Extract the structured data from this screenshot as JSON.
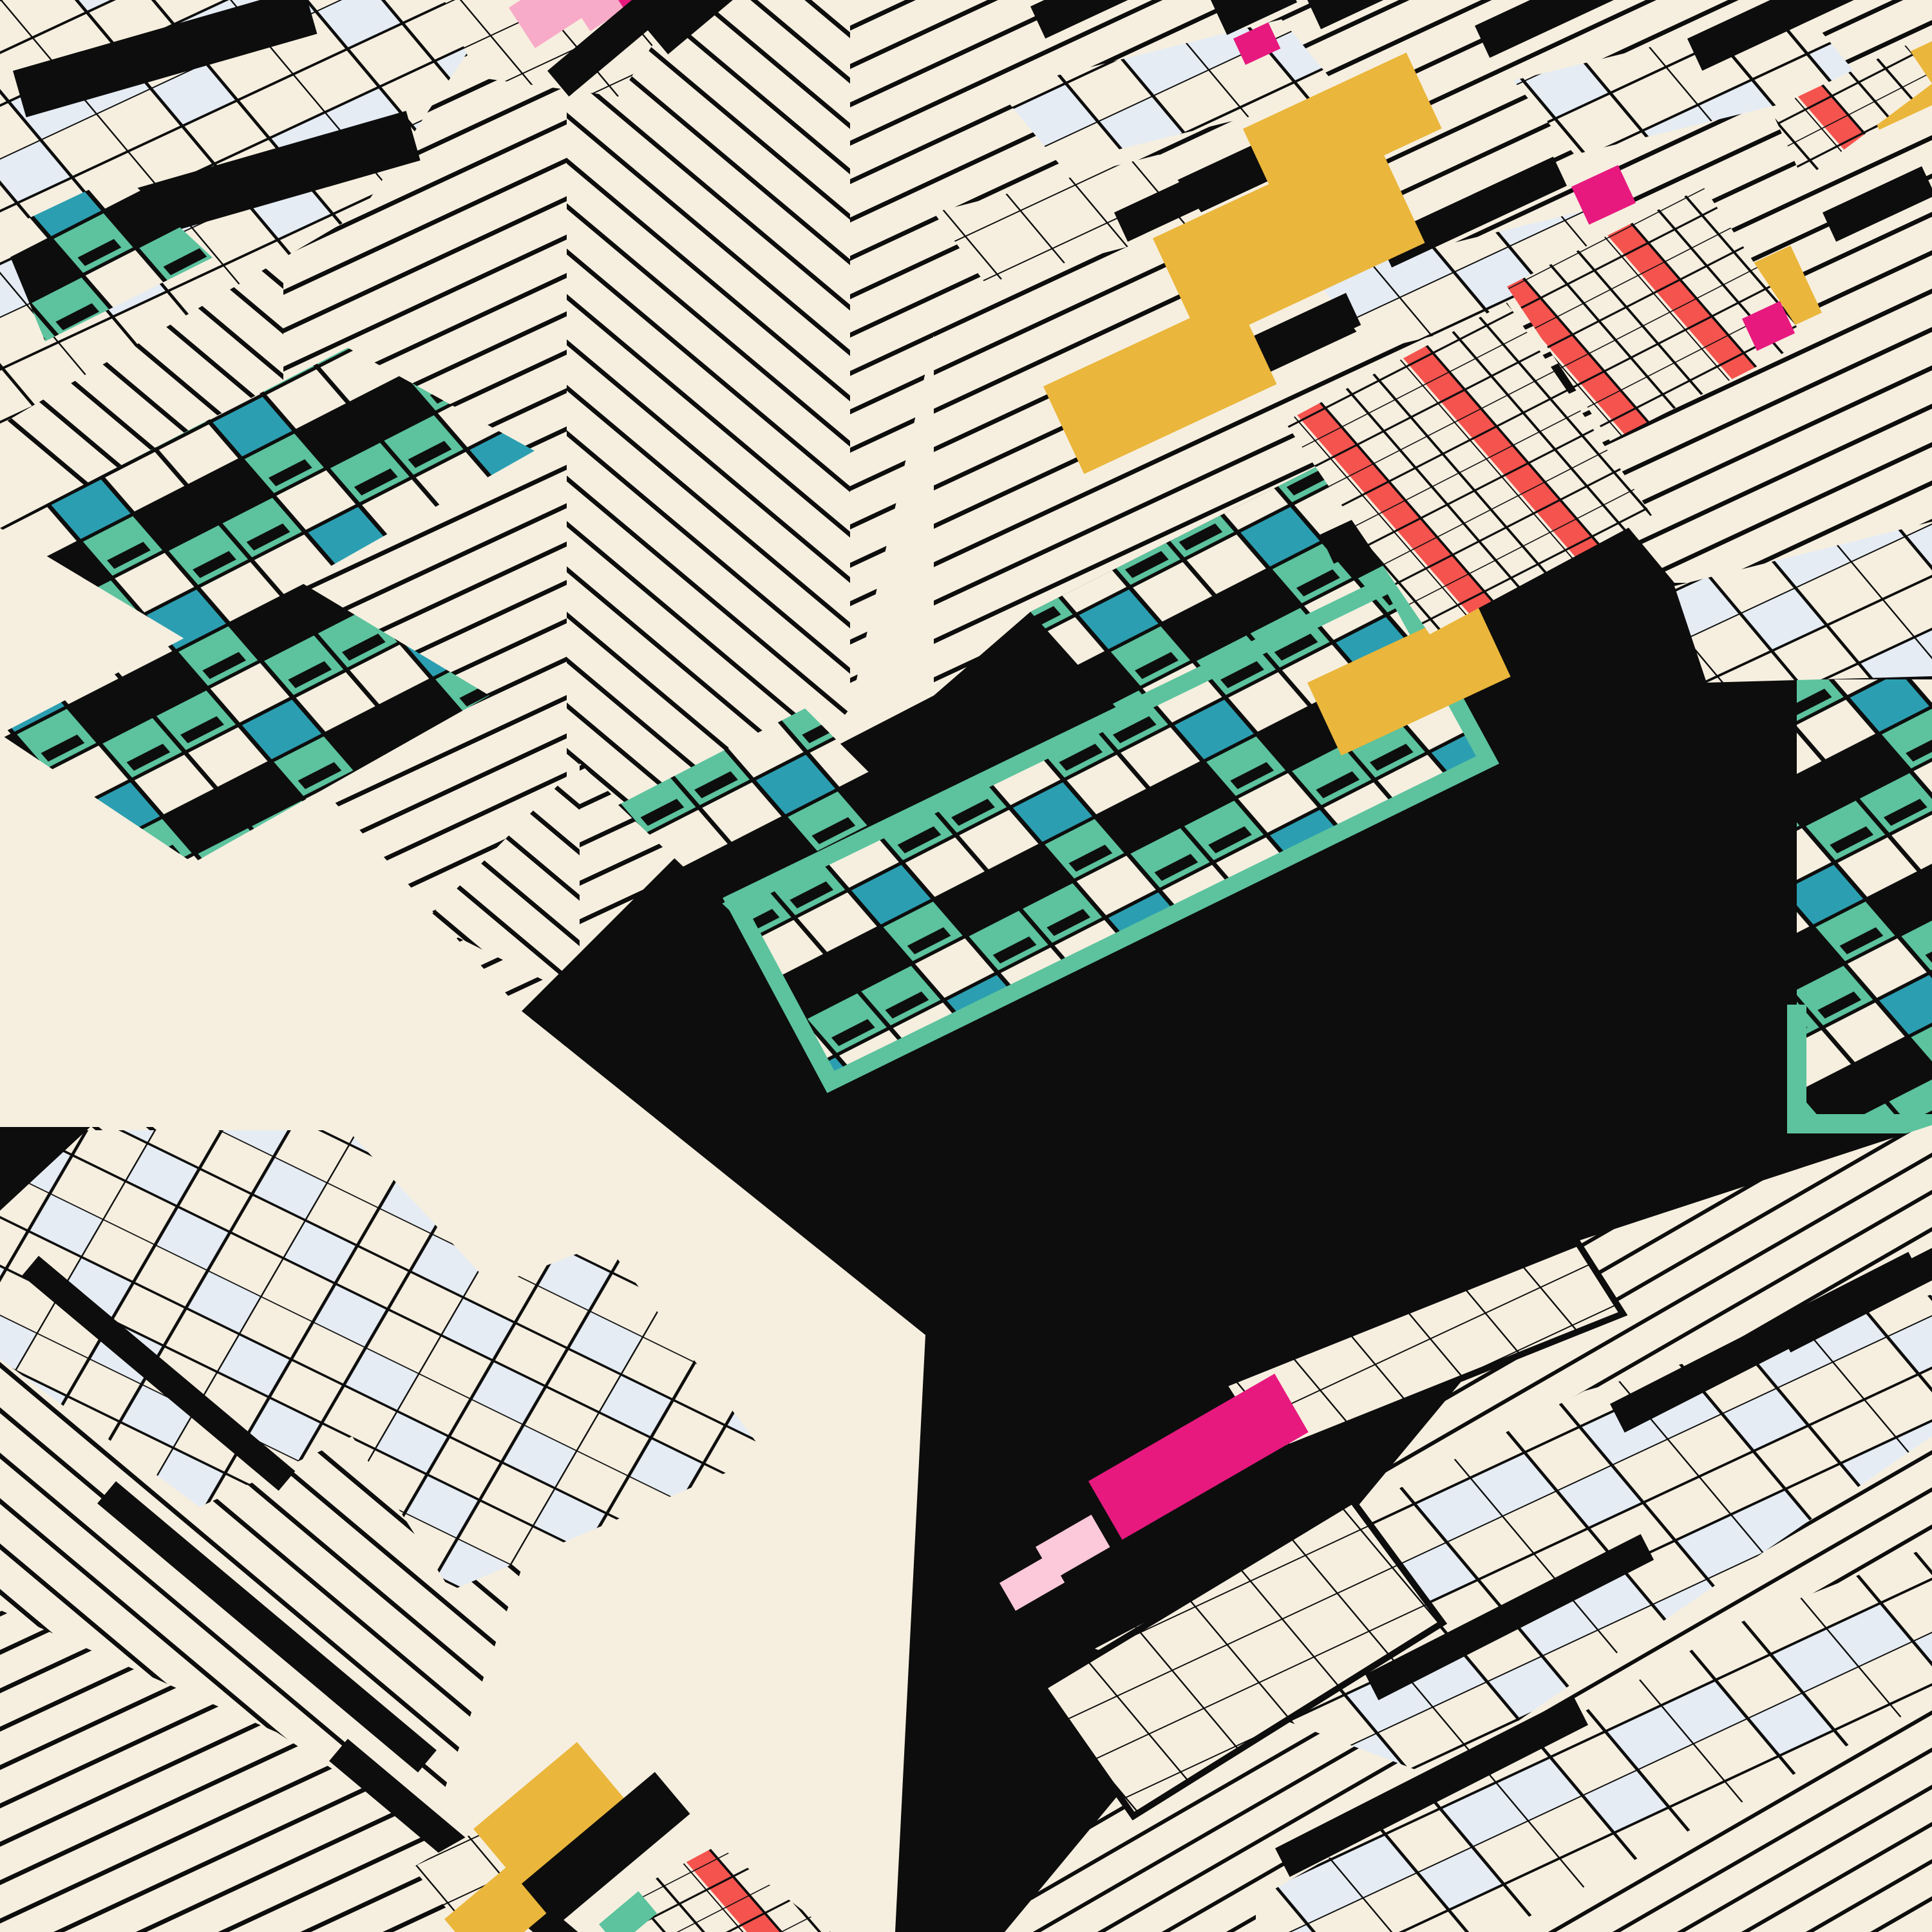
{
  "artwork": {
    "title": "isometric-memphis-generative-composition",
    "style": "axonometric generative art, Memphis palette, no text"
  },
  "palette": {
    "cream": "#f6efdf",
    "ink": "#0d0d0d",
    "teal": "#5cc39e",
    "cyan": "#2b9fb1",
    "yellow": "#eab63b",
    "red": "#f5534e",
    "magenta": "#e7197f",
    "pink": "#f8abc8",
    "pinkPale": "#fbc9d9",
    "blue": "#e5ecf4"
  },
  "scene": {
    "background": "cream field",
    "regions": [
      "top-left herringbone chevron roof",
      "top-left graph-paper patch with black bars",
      "top pink block cluster",
      "top-right diagonal striped facade with yellow bars, red striped panels, magenta blocks, graph patches, black bars",
      "left teal circuit boards",
      "center teal circuit boards with teal frame on black cube",
      "large plain cream cube face",
      "large black cube face",
      "right-edge teal circuit cluster",
      "bottom-left shingled grid building",
      "bottom-right stacked slab building with magenta and pale pink bars",
      "bottom-center yellow red teal cluster",
      "center small chevron fan"
    ]
  },
  "metrics": {
    "canvas": 3000,
    "band_spacing": 54,
    "band_stroke": 7,
    "tile_cell": 95
  }
}
